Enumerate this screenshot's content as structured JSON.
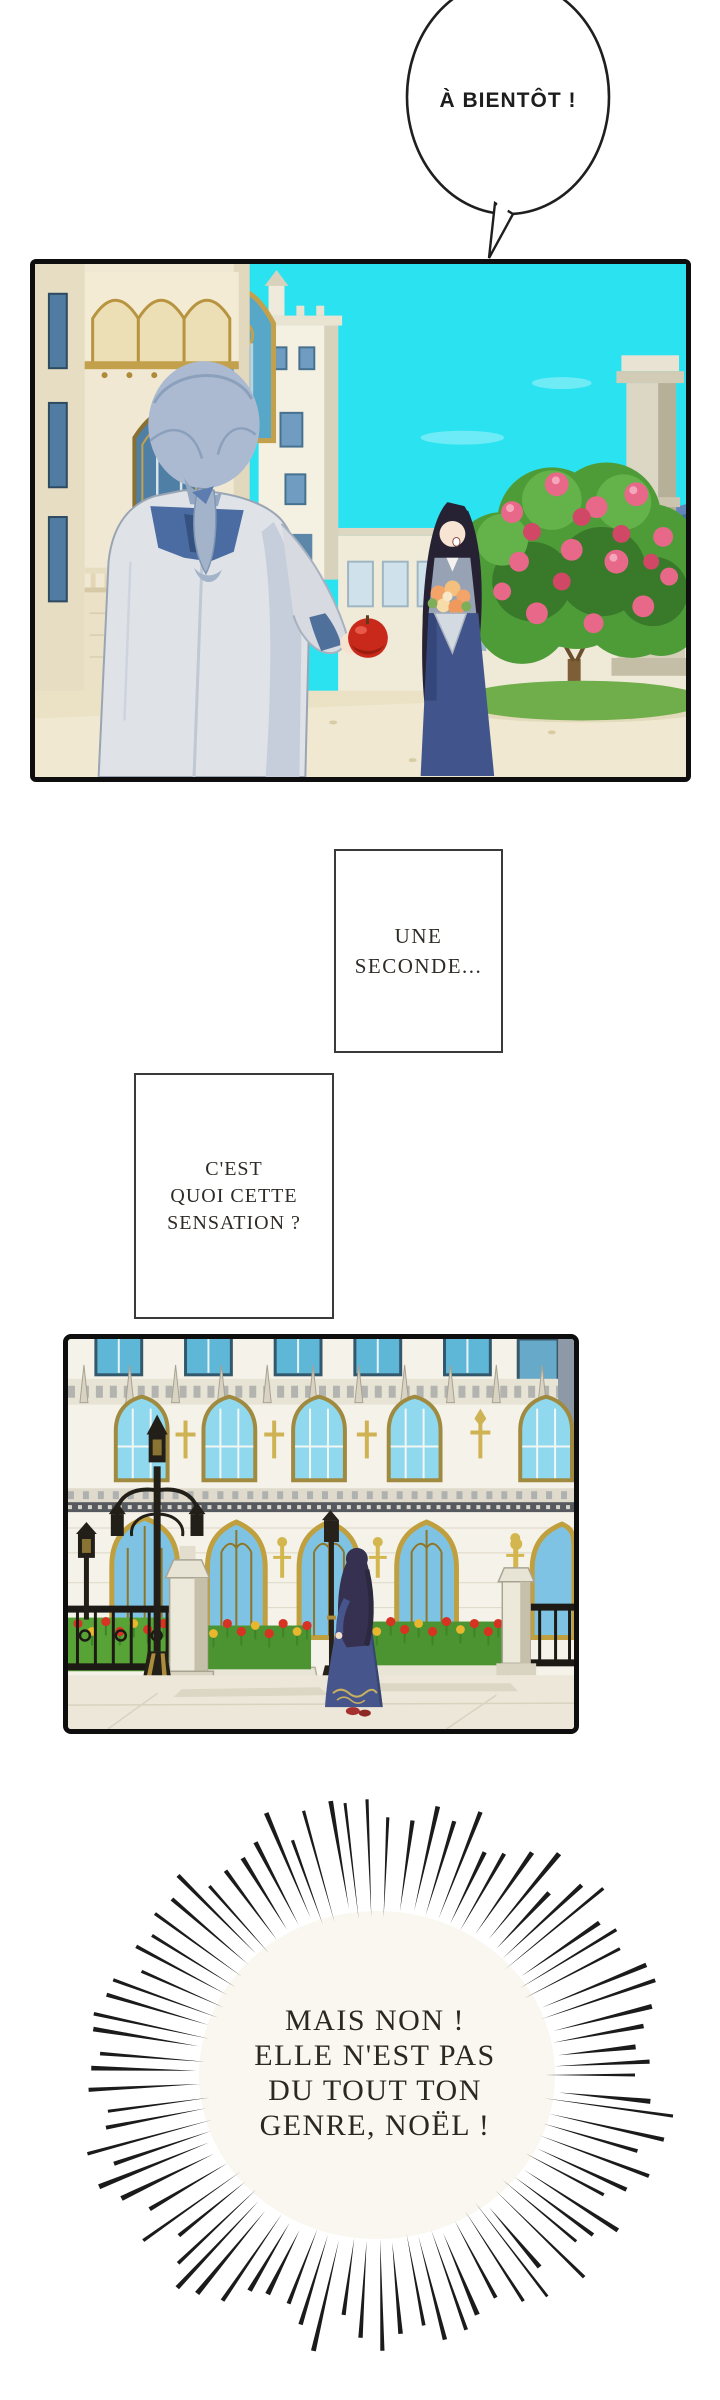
{
  "speech": {
    "bubble": {
      "text": "À BIENTÔT !"
    },
    "box1": {
      "lines": [
        "UNE",
        "SECONDE..."
      ]
    },
    "box2": {
      "lines": [
        "C'EST",
        "QUOI CETTE",
        "SENSATION ?"
      ]
    },
    "burst": {
      "lines": [
        "MAIS NON !",
        "ELLE N'EST PAS",
        "DU TOUT TON",
        "GENRE, NOËL !"
      ]
    }
  },
  "panels": {
    "panel1": {
      "alt": "Homme aux cheveux argentés vu de dos tendant une pomme rouge à une jeune femme brune souriante tenant un bouquet, devant un palais gothique, un rosier et un ciel cyan"
    },
    "panel2": {
      "alt": "La jeune femme en robe bleue s'éloigne dans la cour du palais entre des parterres de tulipes rouges et des lampadaires"
    }
  },
  "colors": {
    "sky_cyan": "#2be2f1",
    "panel_border": "#0e0e0e",
    "text_dark": "#2e2b27",
    "facade_cream": "#f5f2e9",
    "gold_trim": "#c3a14c",
    "window_blue": "#8fd8ee",
    "roof_blue": "#4a6ba0",
    "coat_gray": "#dfe2e7",
    "hair_silver": "#abbad0",
    "collar_blue": "#4a6ca2",
    "woman_hair": "#262233",
    "dress_navy": "#47558d",
    "apple_red": "#c8291a",
    "rose_pink": "#e8688a",
    "bouquet_orange": "#f2a469",
    "tulip_red": "#d63322",
    "tulip_yellow": "#e9b72e",
    "hedge_green": "#4c9332",
    "ground_beige": "#ebe2c6",
    "pavement": "#ece7d8",
    "lamppost_black": "#221e18"
  }
}
